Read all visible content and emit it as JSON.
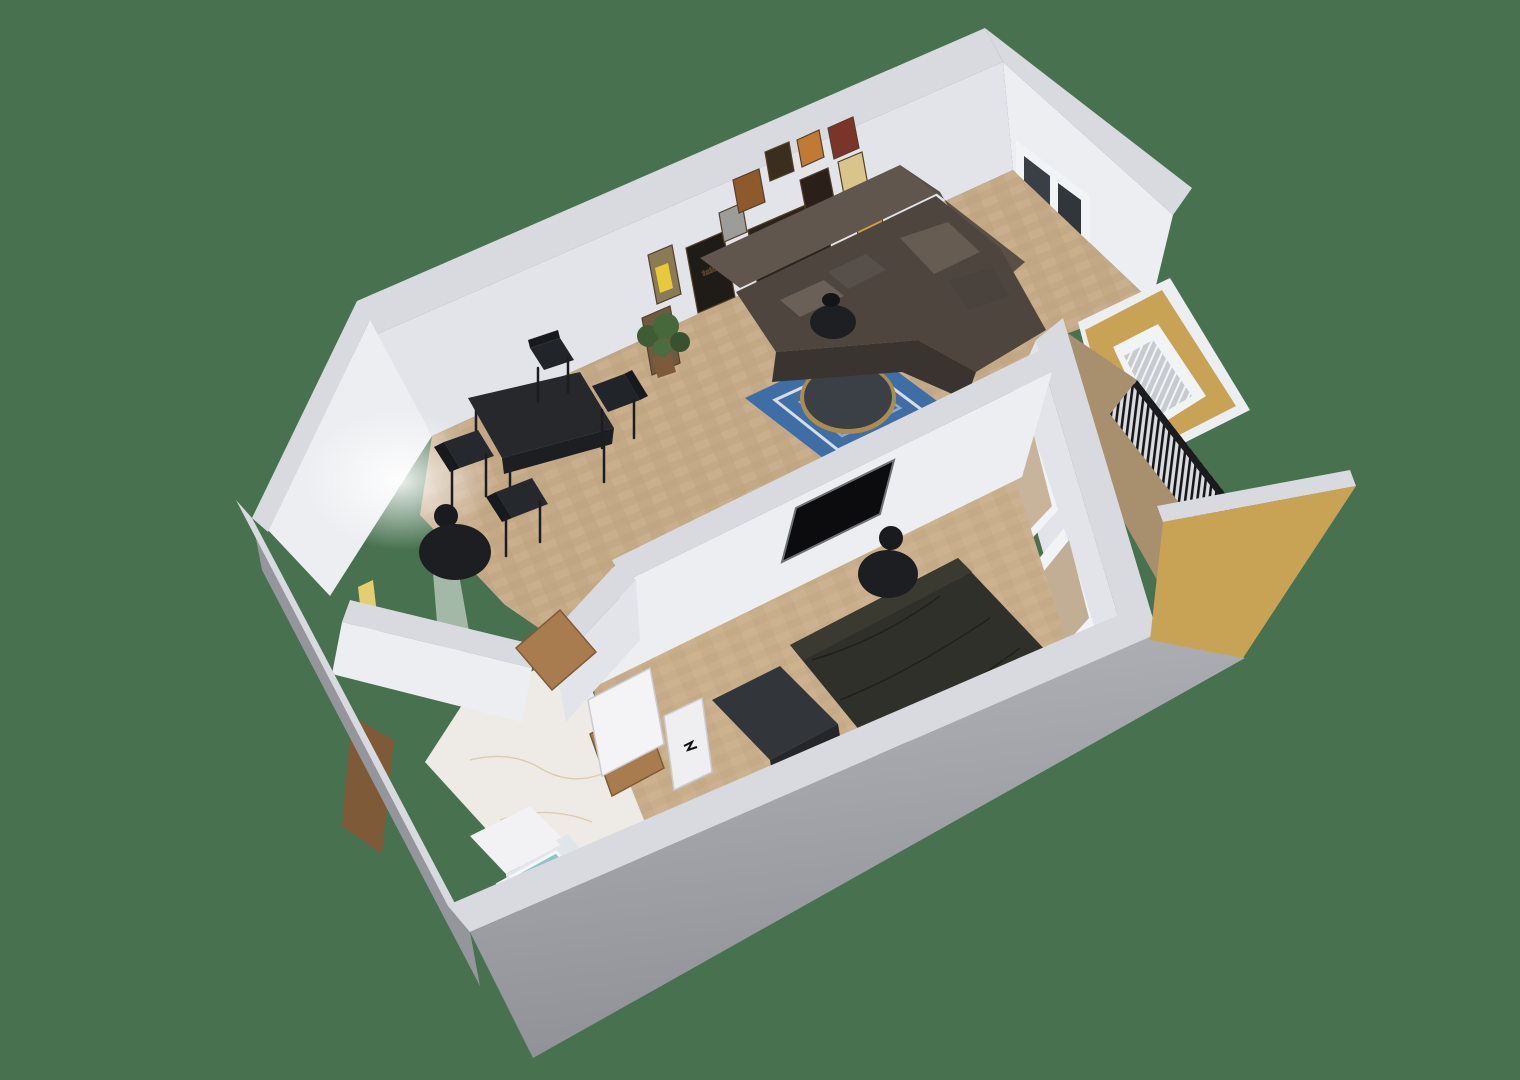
{
  "scene": {
    "type": "3d-floorplan-dollhouse-render",
    "view": "elevated rotated axonometric, one-bedroom apartment, no UI chrome",
    "background_color": "#47714F",
    "poster_text": "Beer Point",
    "framed_posters_count": 13
  },
  "palette": {
    "background": "#47714F",
    "wall_top": "#D8DAE0",
    "wall_face_lit": "#EDEEF1",
    "wall_face_shadow": "#CDD0D8",
    "exterior_gray": "#A5A7AD",
    "parquet": "#C4A987",
    "parquet_light": "#D3BC9C",
    "bedroom_floor": "#C9AE8C",
    "marble": "#EEEBE6",
    "balcony_wood": "#A8906E",
    "ochre_wall": "#C9A355",
    "ochre_wall_light": "#DCBC72",
    "railing_black": "#1B1B1E",
    "sofa_brown": "#4E453E",
    "sofa_brown_dark": "#3A3430",
    "sofa_brown_light": "#60564D",
    "bed_duvet": "#30302A",
    "rug_blue": "#3E6EA5",
    "rug_white": "#D9DDE3",
    "table_black": "#26282C",
    "brass_rim": "#AE8C50",
    "plant_green": "#3F5C35",
    "wood_door": "#A97C50",
    "wood_door_dark": "#7E5A38",
    "shower_teal": "#8CC4C9",
    "tv_black": "#0C0C0E",
    "window_glass": "#3A3F45",
    "lamp_black": "#1A1B1E"
  },
  "rooms": [
    {
      "name": "living-dining-room",
      "floor": "light oak parquet",
      "features": [
        "gallery wall of 13 framed vintage beer posters",
        "brown leather corner sofa with cushions",
        "round coffee table with brass rim on blue geometric rug",
        "black round side table",
        "potted plant",
        "black dining table with 4 chairs",
        "double window",
        "glass door to balcony"
      ]
    },
    {
      "name": "bedroom",
      "floor": "light oak parquet",
      "features": [
        "double bed with dark duvet",
        "TV recessed in partition wall",
        "black disc floor lamp",
        "low dark dresser",
        "sliding glass doors to balcony"
      ]
    },
    {
      "name": "hallway",
      "floor": "light oak parquet",
      "features": [
        "black disc floor lamp",
        "open wooden doors",
        "lit alcove"
      ]
    },
    {
      "name": "bathroom",
      "floor": "white marble",
      "features": [
        "teal shower tray",
        "white cabinet",
        "glass shower divider",
        "white partition wall",
        "white door with black handle",
        "open wooden entry door"
      ]
    },
    {
      "name": "balcony",
      "floor": "wood decking",
      "features": [
        "black vertical-slat railing",
        "ochre yellow painted walls",
        "glass balcony door with white frame"
      ]
    }
  ],
  "furniture": [
    "corner-sofa",
    "throw-pillows",
    "side-table",
    "coffee-table",
    "area-rug",
    "potted-plant",
    "dining-table",
    "dining-chair",
    "floor-lamp-hall",
    "floor-lamp-bedroom",
    "double-bed",
    "dresser",
    "recessed-tv",
    "washer-cabinet",
    "shower-tray",
    "glass-divider",
    "poster-frame",
    "window",
    "glass-door",
    "wooden-door",
    "white-door",
    "balcony-railing"
  ]
}
